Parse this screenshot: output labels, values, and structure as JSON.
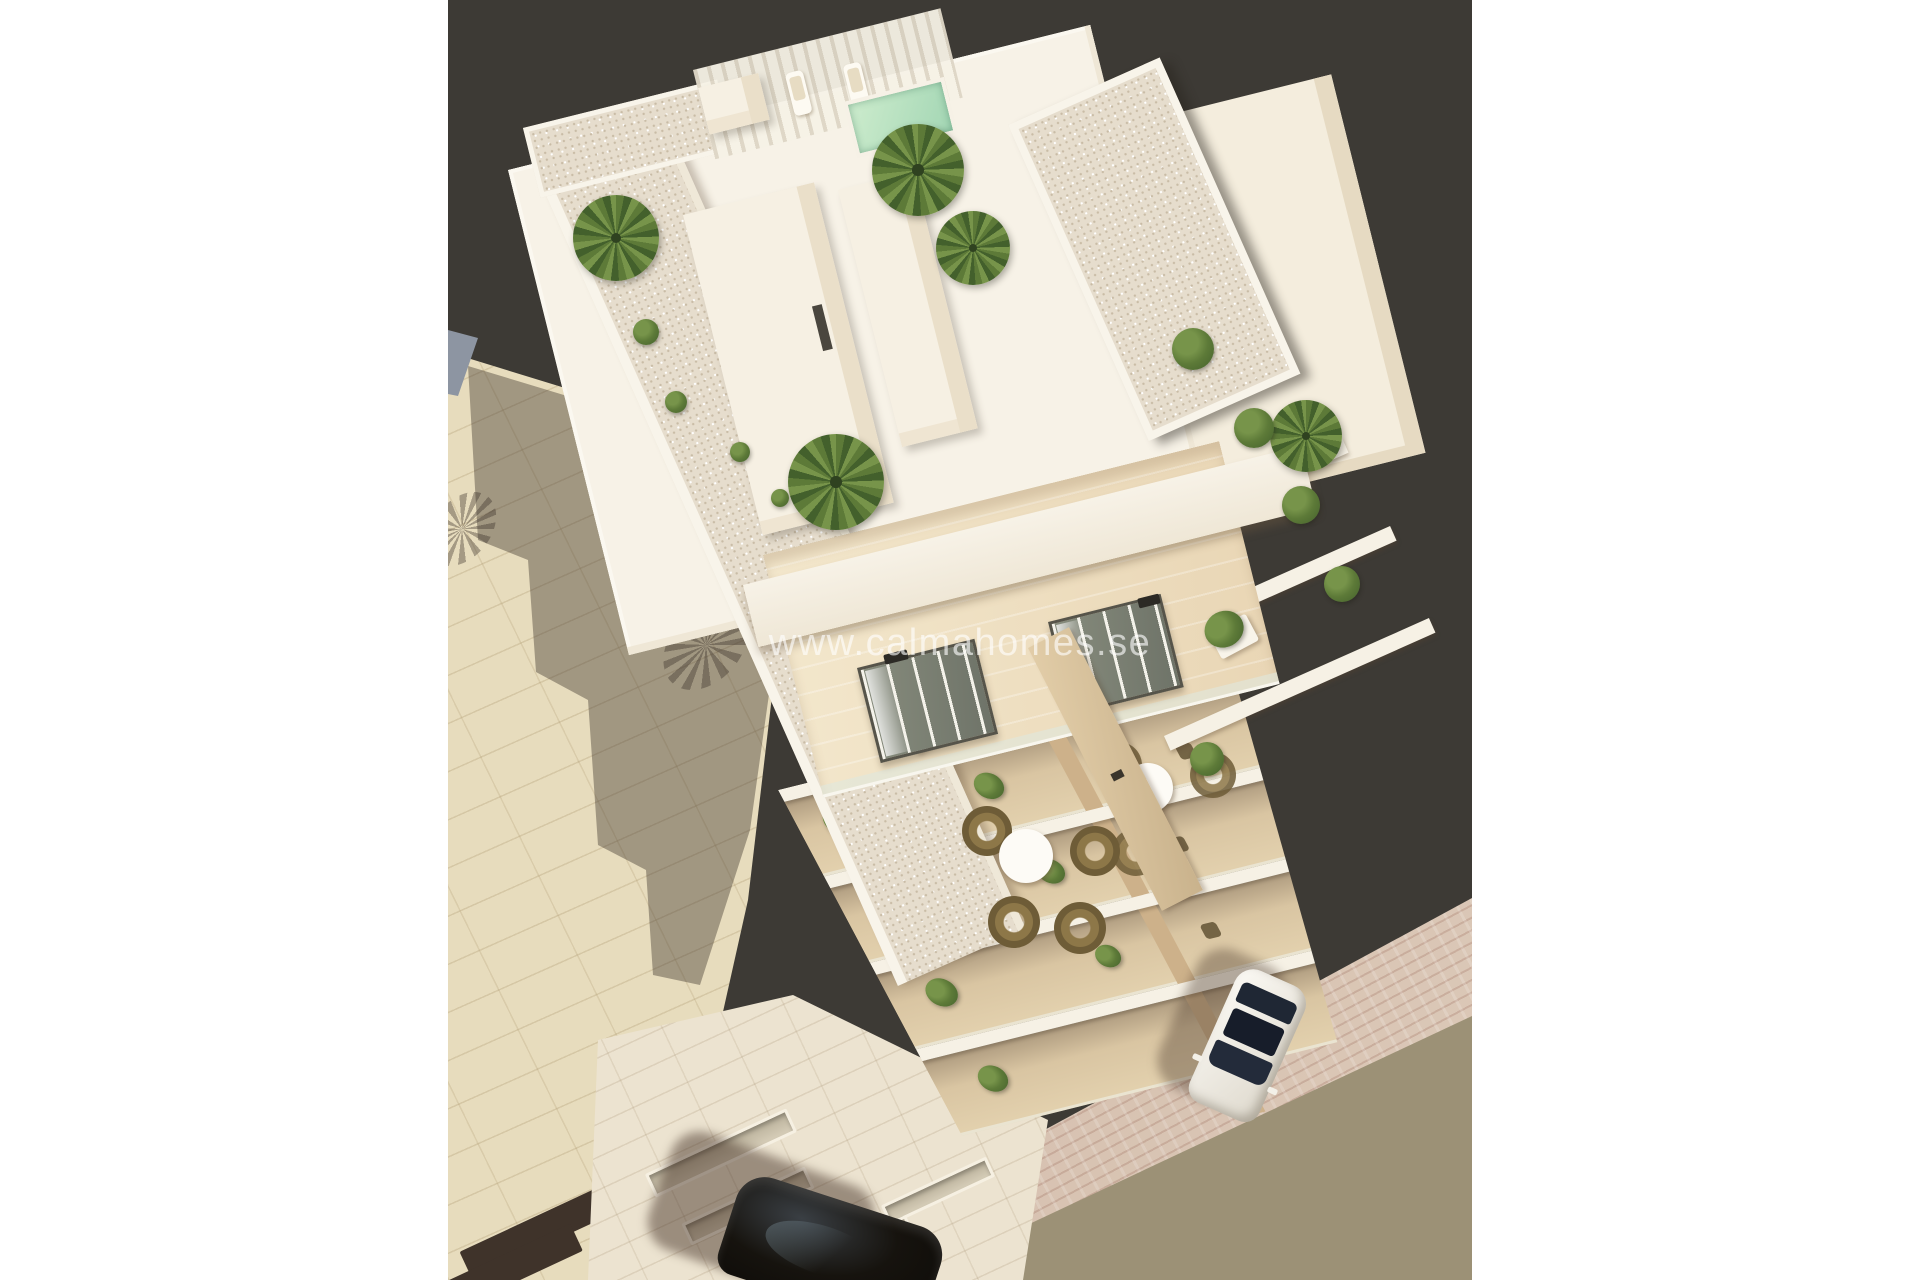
{
  "watermark": {
    "text": "www.calmahomes.se"
  },
  "scene": {
    "description": "Aerial 3D architectural rendering of a white modern apartment building with rooftop terraces, palm trees, a small pool, stacked balconies with plants, a tiled plaza, a street with a parked white car and a black car at the bottom edge",
    "colors": {
      "page_bg": "#ffffff",
      "backdrop": "#3d3a35",
      "roof_white": "#f7f2e7",
      "gravel": "#e6ddcd",
      "gravel_dot": "#c9bca6",
      "terrace_floor": "#e9d6b5",
      "door_glass": "#6e7368",
      "divider_wood": "#c9b28c",
      "table_white": "#fdfbf6",
      "rattan": "#8d7748",
      "foliage": "#5d7a38",
      "foliage_dark": "#43602c",
      "foliage_light": "#77944a",
      "pool_water": "#cdeccd",
      "plaza_tile": "#e7dcbd",
      "shadow_overlay": "rgba(64,54,46,0.42)",
      "wall_blue": "#8d95a2",
      "ground_wall": "#ece3d0",
      "sidewalk_brick": "#d5bfae",
      "sidewalk_rose": "#c09a8c",
      "street_asphalt": "#9c9176",
      "stripe_dark": "#3f332a",
      "car_white": "#ded9cd",
      "car_glass": "#1f2734",
      "car_black": "#16130e"
    }
  }
}
